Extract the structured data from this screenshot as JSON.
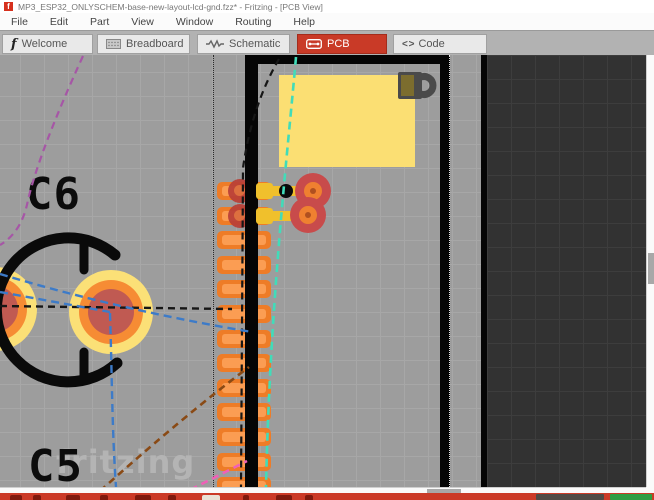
{
  "window": {
    "title": "MP3_ESP32_ONLYSCHEM-base-new-layout-lcd-gnd.fzz* - Fritzing - [PCB View]",
    "app_icon_glyph": "f"
  },
  "menu": {
    "items": [
      "File",
      "Edit",
      "Part",
      "View",
      "Window",
      "Routing",
      "Help"
    ]
  },
  "tabs": [
    {
      "label": "Welcome",
      "icon": "fritzing-f-icon",
      "glyph": "f",
      "active": false
    },
    {
      "label": "Breadboard",
      "icon": "breadboard-icon",
      "active": false
    },
    {
      "label": "Schematic",
      "icon": "schematic-zigzag-icon",
      "active": false
    },
    {
      "label": "PCB",
      "icon": "pcb-board-icon",
      "active": true
    },
    {
      "label": "Code",
      "icon": "code-brackets-icon",
      "glyph": "< >",
      "active": false
    }
  ],
  "canvas": {
    "silkscreen_labels": {
      "c6": "C6",
      "c5": "C5"
    },
    "watermark": "fritzing",
    "pcb": {
      "smd_pad_rows": 13
    },
    "colors": {
      "canvas_bg": "#9d9d9d",
      "dark_board": "#323232",
      "board_outline": "#050505",
      "copper_pad_orange": "#ee7c27",
      "trace_yellow": "#f0c02c",
      "cap_pad_ring_yellow": "#fbe077",
      "cap_pad_ring_orange": "#f68c34",
      "cap_pad_center_red": "#c05a52",
      "ratsnest_cyan": "#41dcb9",
      "ratsnest_blue": "#3d7bc8",
      "ratsnest_purple": "#a656a6",
      "ratsnest_black": "#161616",
      "ratsnest_brown": "#8a4a15",
      "ratsnest_pink": "#f060b8"
    }
  },
  "accent": {
    "fritzing_red": "#cb3a27",
    "toolbar_green": "#2f9e44"
  }
}
